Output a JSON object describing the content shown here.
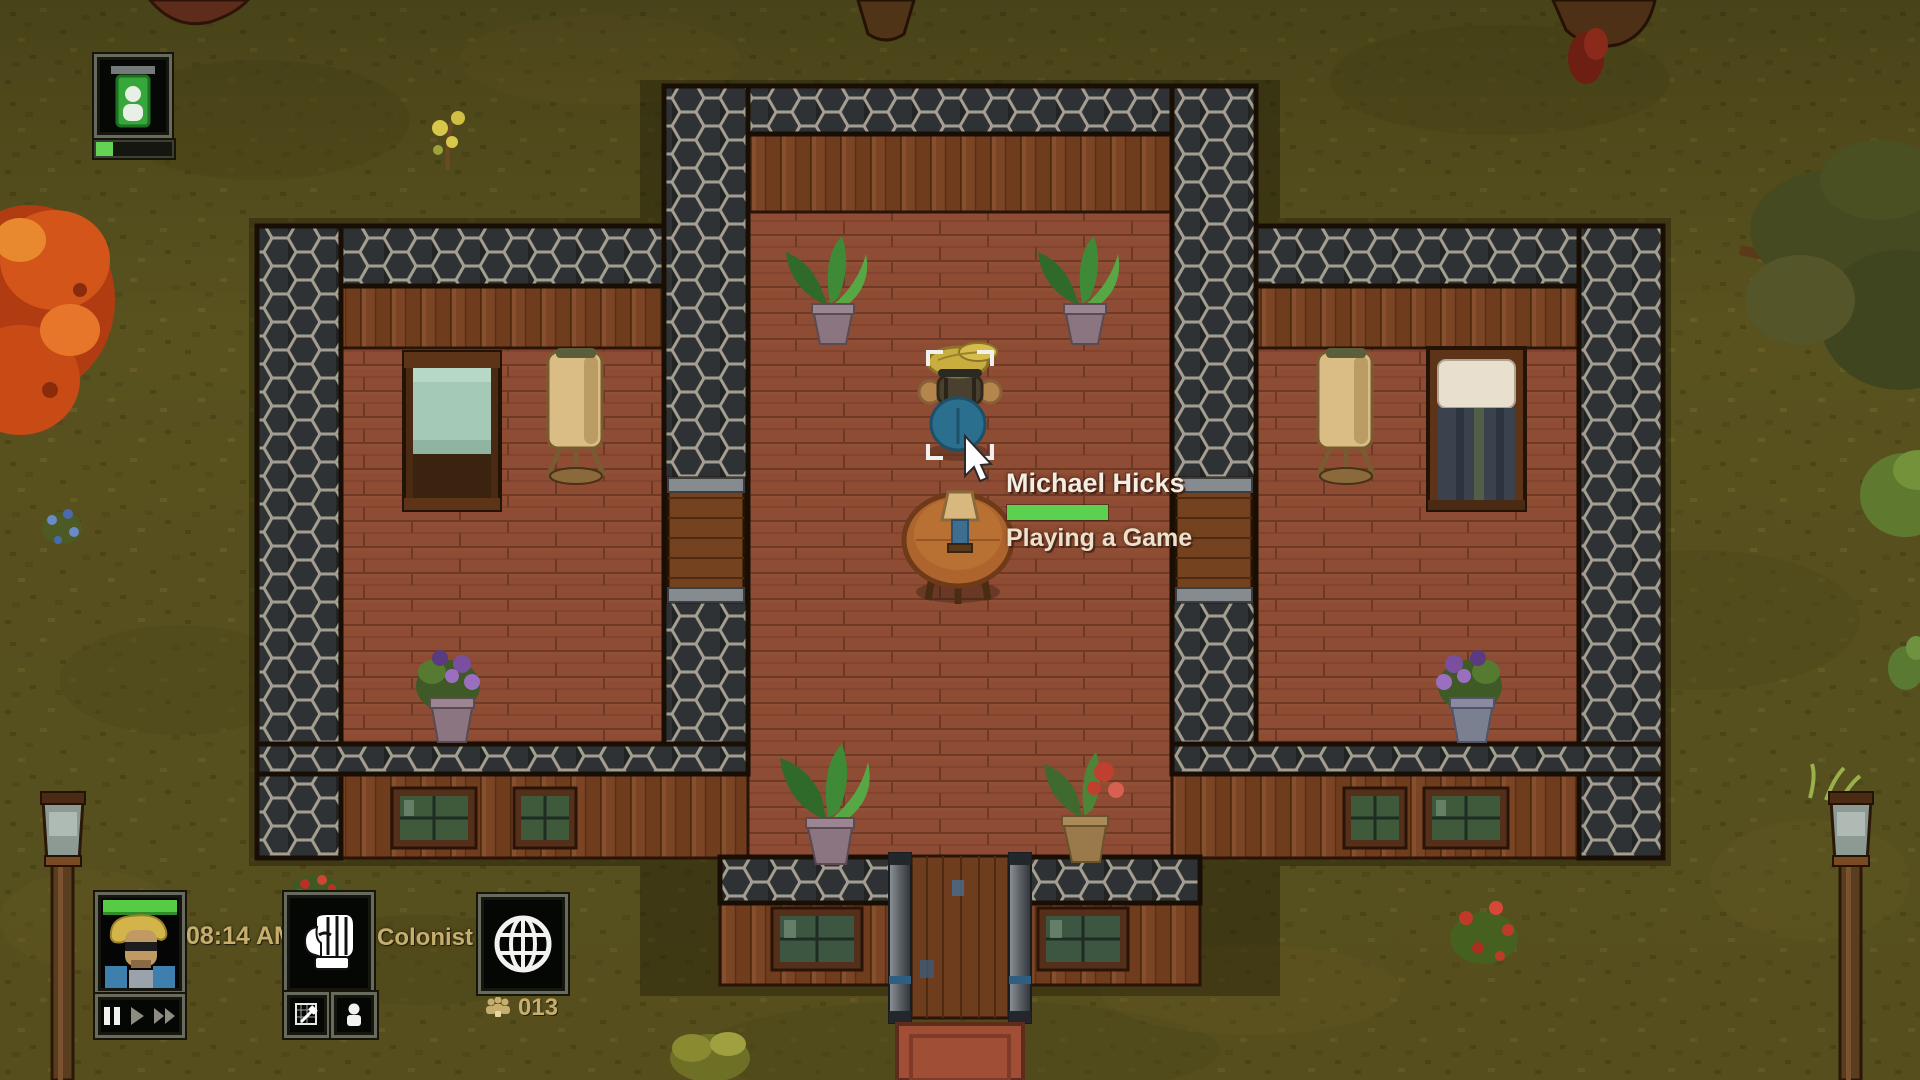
{
  "hud": {
    "clock_time": "08:14 AM",
    "selection_label": "Colonist",
    "population_count": "013",
    "speed_controls": {
      "buttons": [
        "pause",
        "play",
        "fast-forward"
      ],
      "active": "pause"
    },
    "top_left_colonist_meter_percent": 22,
    "buttons": [
      "colonist-portrait",
      "hand-tool",
      "architect-blueprint",
      "colonist-list",
      "world-map"
    ]
  },
  "selected_colonist": {
    "name": "Michael Hicks",
    "activity": "Playing a Game",
    "activity_progress_percent": 100
  },
  "scene_entities": [
    "colonist-character",
    "round-table",
    "table-lamp",
    "bed-left-room",
    "bed-right-room",
    "floor-lamp",
    "potted-plant",
    "flower-pot",
    "entrance-door",
    "interior-door",
    "window",
    "lamp-post",
    "maple-tree",
    "tree-canopy",
    "berry-bush",
    "doormat"
  ],
  "colors": {
    "hud_text": "#c6ae6e",
    "progress_green": "#5cd04f",
    "grass": "#59521f",
    "floor_wood": "#8d4c33",
    "wall_stone": "#2f3234",
    "wall_mortar": "#a39e90"
  }
}
